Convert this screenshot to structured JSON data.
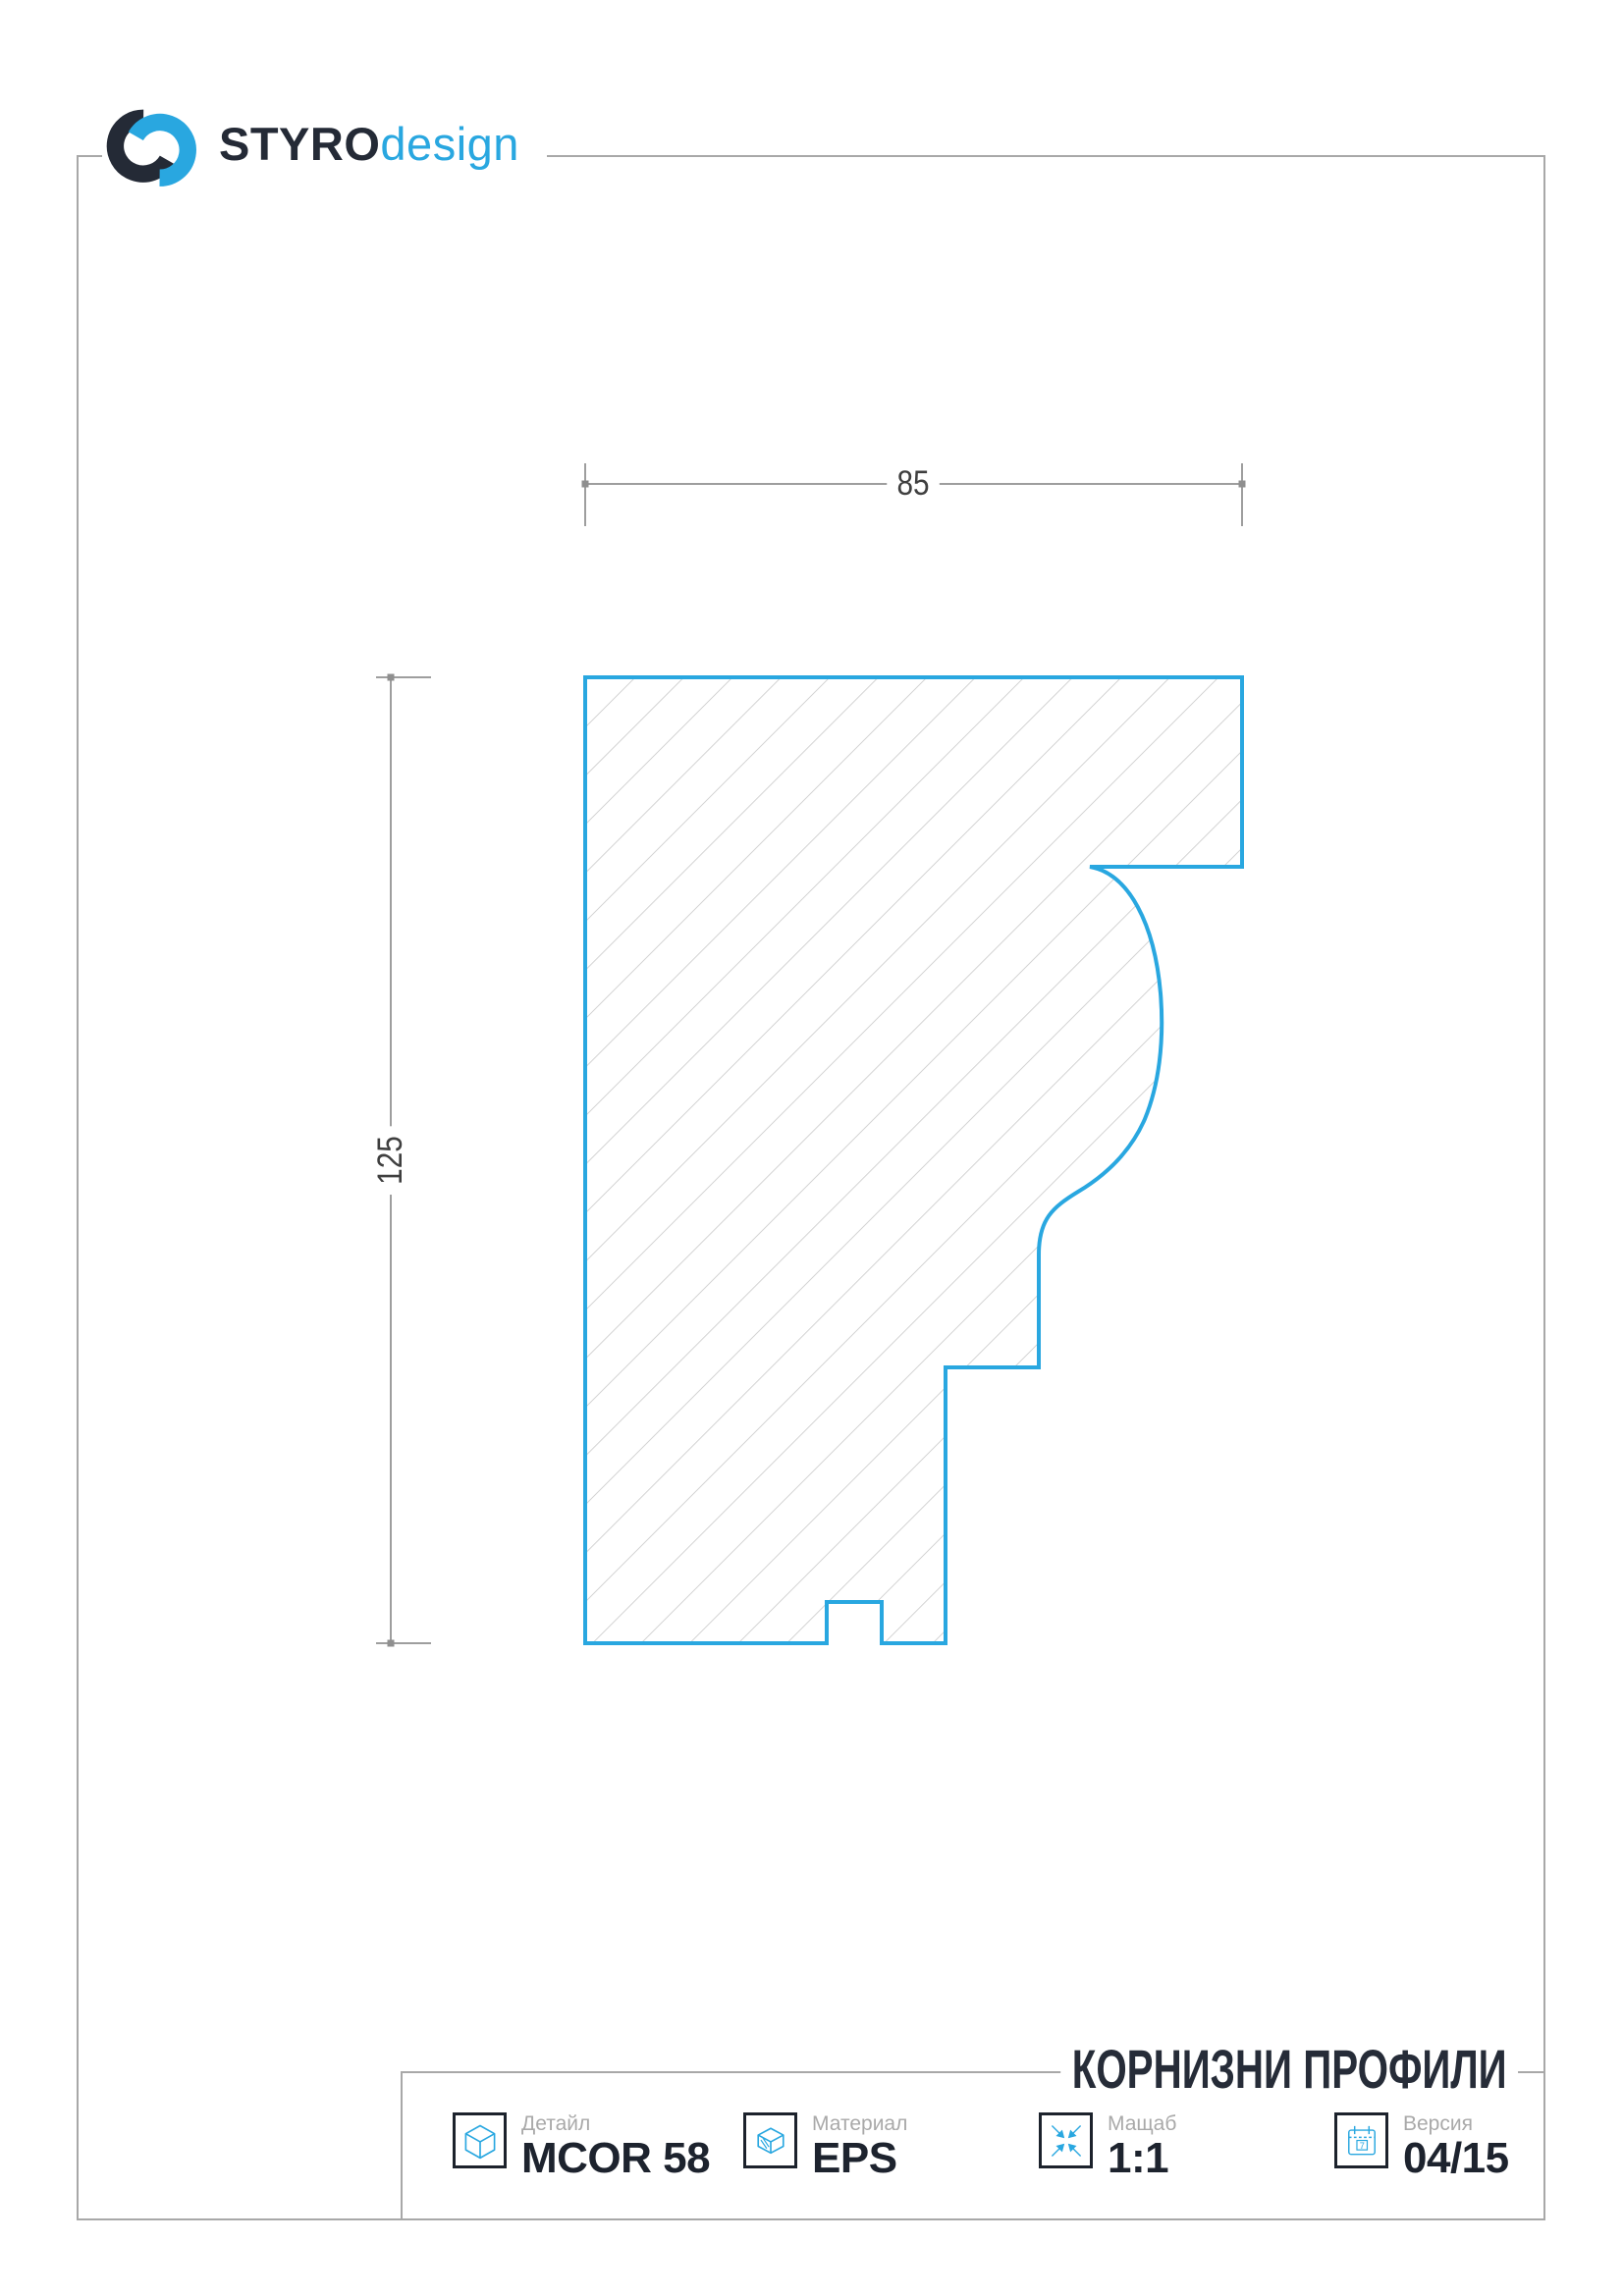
{
  "brand": {
    "name_bold": "STYRO",
    "name_light": "design"
  },
  "drawing": {
    "width_label": "85",
    "height_label": "125",
    "profile_path": "M 596 690 L 1265 690 L 1265 883 L 1110 883 C 1150 890 1176 942 1182 1012 C 1186 1062 1180 1106 1166 1140 C 1152 1172 1128 1196 1098 1214 C 1072 1230 1058 1242 1058 1278 L 1058 1393 L 963 1393 L 963 1674 L 898 1674 L 898 1632 L 842 1632 L 842 1674 L 596 1674 Z"
  },
  "footer": {
    "title": "КОРНИЗНИ ПРОФИЛИ",
    "items": [
      {
        "label": "Детайл",
        "value": "MCOR 58",
        "icon": "cube-icon"
      },
      {
        "label": "Материал",
        "value": "EPS",
        "icon": "material-icon"
      },
      {
        "label": "Мащаб",
        "value": "1:1",
        "icon": "scale-icon"
      },
      {
        "label": "Версия",
        "value": "04/15",
        "icon": "calendar-icon"
      }
    ],
    "calendar_digit": "7"
  },
  "colors": {
    "accent": "#29a7e0",
    "dark_text": "#242a36",
    "frame_gray": "#a8a8a8",
    "hatch_gray": "#c3c3c3"
  }
}
